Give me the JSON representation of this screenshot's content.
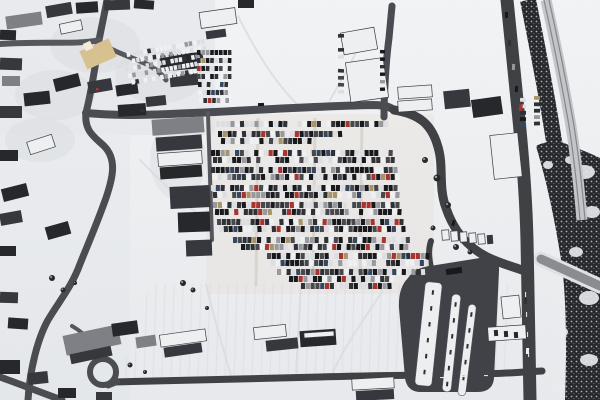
{
  "scene": {
    "type": "aerial photograph",
    "description": "Winter aerial view of a snow-covered town: a large car park full of vehicles in the centre, village buildings to the left, a transit loop with platforms at lower right, a main road and railway line along the right edge, and snow-covered fields."
  },
  "palette": {
    "snow_top": "#f3f4f6",
    "snow_bottom": "#e8eaed",
    "road_dark": "#3f4145",
    "road_mid": "#4a4c51",
    "road_light": "#55575c",
    "asphalt": "#404247",
    "d1": "#26282c",
    "d2": "#36383d",
    "g": "#7e8085",
    "w": "#edeff1",
    "b_stroke": "#3a3c40",
    "church": "#d8c190",
    "church_tower": "#f3ecd9",
    "veg_dark": "#26282b",
    "veg_dot1": "#cfd1d4",
    "veg_dot2": "#9fa1a5",
    "rail_bed": "#c3c5c9",
    "rail_line": "#85878b",
    "bridge": "#8a8c90",
    "bridge_edge": "#dfe1e4",
    "trail": "#d9dbde",
    "track": "#d2ccc4",
    "snow_blob": "#e9ebee",
    "island": "#eceef0",
    "island_stroke": "#54565a",
    "island_dash": "#2e3033",
    "dash_white": "#f2f3f5",
    "car_dark1": "#17191c",
    "car_dark2": "#2e3135",
    "car_dark3": "#46484c",
    "car_light1": "#dcdee1",
    "car_light2": "#eef0f2",
    "car_gray": "#97999d",
    "car_red": "#a8332f",
    "car_blue": "#35465f",
    "car_tan": "#a8946a"
  },
  "ground": {
    "town_tint": {
      "path": "M0,0 L215,0 L215,135 L0,135 Z",
      "color": "#e0e2e6",
      "op": 0.5
    },
    "left_tint": {
      "path": "M0,135 L130,135 L130,400 L0,400 Z",
      "color": "#e0e2e6",
      "op": 0.28
    },
    "lot_tint": {
      "x": 206,
      "y": 114,
      "w": 228,
      "h": 180,
      "color": "#e7e1d8",
      "op": 0.42
    },
    "patches": [
      [
        95,
        45,
        45,
        28
      ],
      [
        55,
        95,
        40,
        25
      ],
      [
        160,
        75,
        45,
        28
      ],
      [
        40,
        140,
        35,
        22
      ],
      [
        178,
        160,
        28,
        40
      ]
    ],
    "patch_color": "#d4d6da",
    "patch_op": 0.35,
    "streak_region": {
      "path": "M150,284 L508,284 L508,372 L120,378 Z",
      "op": 0.5
    }
  },
  "trails": [
    "M238,16 C255,50 276,84 298,105",
    "M330,100 C345,74 356,54 364,36",
    "M206,284 C214,320 224,350 231,376",
    "M301,287 C299,320 297,350 296,375",
    "M382,292 C362,322 342,350 332,375",
    "M140,160 C165,185 185,205 206,220"
  ],
  "lot_tracks": [
    "M258,118 L256,286",
    "M315,118 L313,288",
    "M362,120 L360,288"
  ],
  "vegetation": {
    "main": "M536,146 C548,186 556,226 562,266 C566,298 567,340 565,400 L600,400 L600,158 C588,152 576,148 564,143 C554,140 544,142 536,146 Z",
    "tree_band": "M528,0 C537,45 546,90 553,135 C559,170 564,200 568,228",
    "tree_band_width": 16,
    "snow_blobs": [
      [
        584,
        172,
        11,
        7
      ],
      [
        592,
        212,
        8,
        6
      ],
      [
        576,
        252,
        7,
        5
      ],
      [
        589,
        298,
        10,
        7
      ],
      [
        562,
        332,
        6,
        5
      ],
      [
        589,
        360,
        9,
        6
      ],
      [
        558,
        388,
        7,
        4
      ],
      [
        571,
        160,
        6,
        4
      ],
      [
        548,
        165,
        5,
        4
      ]
    ]
  },
  "railway": {
    "bed": "M546,0 C555,40 563,80 570,120 C575,150 579,185 582,220",
    "line1": "M544,0 C553,40 561,80 568,120 C573,150 577,185 580,220",
    "line2": "M549,0 C558,40 566,80 573,120 C578,150 582,185 585,220",
    "bed_w": 11
  },
  "bridge": {
    "path": "M541,259 L600,286",
    "deck_w": 9,
    "edge_w": 15
  },
  "roads": [
    {
      "n": "road-main-horizontal",
      "p": "M86,113 C130,117 170,114 215,112 C270,109 330,106 372,105 C382,105 389,106 394,110",
      "w": 8,
      "c": "road_mid"
    },
    {
      "n": "road-town-north",
      "p": "M107,0 C104,16 101,30 99,40 C96,62 92,88 86,113",
      "w": 7,
      "c": "road_mid"
    },
    {
      "n": "road-town-west",
      "p": "M99,40 C80,45 40,41 0,44",
      "w": 6,
      "c": "road_light"
    },
    {
      "n": "road-town-spur",
      "p": "M99,42 C114,52 128,56 142,62 C152,66 160,72 166,80",
      "w": 5,
      "c": "road_light"
    },
    {
      "n": "road-diagonal",
      "p": "M86,113 C84,132 96,138 104,146 C118,160 112,180 106,198 C96,226 88,244 80,264 C72,286 60,300 48,320 C38,338 30,368 28,400",
      "w": 7,
      "c": "road_mid"
    },
    {
      "n": "road-lane-east",
      "p": "M208,113 L212,240",
      "w": 4,
      "c": "road_light"
    },
    {
      "n": "road-north-vertical",
      "p": "M384,117 C384,95 386,60 389,38 C390,28 391,16 392,6",
      "w": 7,
      "c": "road_mid"
    },
    {
      "n": "road-s-curve",
      "p": "M394,110 C420,114 432,125 438,147 C444,167 438,186 446,208 C454,232 468,247 487,257 C502,264 514,267 522,270",
      "w": 9,
      "c": "road_dark"
    },
    {
      "n": "road-loop-connector",
      "p": "M431,268 C429,258 428,250 431,241",
      "w": 6,
      "c": "road_dark"
    },
    {
      "n": "road-main-vertical",
      "p": "M507,0 C511,40 515,80 519,120 C523,160 526,200 527,240 C528,280 529,330 530,400",
      "w": 13,
      "c": "road_dark"
    },
    {
      "n": "road-bottom",
      "p": "M114,382 C180,381 250,379 320,377 C390,375 450,375 480,374 C500,374 520,372 542,371",
      "w": 7,
      "c": "road_dark"
    },
    {
      "n": "road-bottom-left",
      "p": "M0,377 C20,384 42,393 62,400",
      "w": 7,
      "c": "road_mid"
    },
    {
      "n": "road-circle-spur",
      "p": "M101,358 C96,346 86,334 72,326",
      "w": 4,
      "c": "road_light"
    },
    {
      "n": "road-circle-link",
      "p": "M108,386 L118,382",
      "w": 5,
      "c": "road_mid"
    }
  ],
  "circle_drive": {
    "cx": 103,
    "cy": 372,
    "r": 13,
    "w": 6
  },
  "transit": {
    "apron": "M408,278 Q414,268 430,266 L486,257 Q500,257 499,271 L494,378 Q493,392 477,392 L421,392 Q407,392 405,378 L399,308 Q398,288 408,278 Z",
    "islands": [
      [
        420,
        282,
        17,
        104,
        6
      ],
      [
        447,
        294,
        9,
        98,
        6
      ],
      [
        463,
        304,
        8,
        92,
        7
      ]
    ],
    "bus": [
      446,
      268,
      16,
      6,
      -8
    ]
  },
  "church": {
    "main": [
      82,
      44,
      32,
      20,
      -24
    ],
    "tower": [
      84,
      42,
      8,
      8,
      -24
    ]
  },
  "buildings": [
    [
      6,
      14,
      36,
      13,
      -8,
      "g"
    ],
    [
      46,
      4,
      26,
      12,
      -10,
      "d2"
    ],
    [
      76,
      2,
      22,
      11,
      -4,
      "d1"
    ],
    [
      104,
      0,
      26,
      10,
      -2,
      "d2"
    ],
    [
      134,
      0,
      20,
      9,
      4,
      "d1"
    ],
    [
      60,
      22,
      22,
      10,
      -12,
      "w"
    ],
    [
      0,
      30,
      16,
      10,
      2,
      "d1"
    ],
    [
      0,
      58,
      22,
      12,
      2,
      "d2"
    ],
    [
      2,
      76,
      18,
      10,
      0,
      "g"
    ],
    [
      54,
      76,
      26,
      13,
      -14,
      "d1"
    ],
    [
      88,
      80,
      24,
      12,
      -10,
      "d2"
    ],
    [
      116,
      84,
      22,
      11,
      -8,
      "d1"
    ],
    [
      160,
      54,
      38,
      16,
      -5,
      "d1"
    ],
    [
      170,
      74,
      28,
      12,
      -5,
      "d2"
    ],
    [
      24,
      92,
      26,
      13,
      -6,
      "d1"
    ],
    [
      0,
      106,
      22,
      12,
      0,
      "d2"
    ],
    [
      118,
      104,
      28,
      12,
      -4,
      "d1"
    ],
    [
      146,
      96,
      20,
      10,
      -6,
      "d2"
    ],
    [
      200,
      10,
      36,
      16,
      -8,
      "w"
    ],
    [
      206,
      30,
      20,
      8,
      -8,
      "d2"
    ],
    [
      238,
      0,
      16,
      8,
      0,
      "d1"
    ],
    [
      28,
      138,
      26,
      13,
      -18,
      "w"
    ],
    [
      0,
      150,
      18,
      11,
      0,
      "d1"
    ],
    [
      2,
      186,
      26,
      13,
      -14,
      "d1"
    ],
    [
      0,
      212,
      22,
      12,
      -10,
      "d2"
    ],
    [
      46,
      224,
      24,
      13,
      -16,
      "d1"
    ],
    [
      0,
      246,
      16,
      10,
      0,
      "d1"
    ],
    [
      0,
      292,
      18,
      11,
      2,
      "d2"
    ],
    [
      8,
      318,
      20,
      11,
      4,
      "d1"
    ],
    [
      152,
      118,
      52,
      16,
      -4,
      "g"
    ],
    [
      156,
      136,
      46,
      14,
      -4,
      "d2"
    ],
    [
      158,
      152,
      44,
      13,
      -4,
      "w"
    ],
    [
      160,
      166,
      42,
      12,
      -4,
      "d1"
    ],
    [
      170,
      186,
      40,
      22,
      -3,
      "d2"
    ],
    [
      178,
      212,
      32,
      20,
      -2,
      "d1"
    ],
    [
      186,
      240,
      26,
      16,
      -2,
      "d2"
    ],
    [
      342,
      30,
      34,
      22,
      -10,
      "w"
    ],
    [
      348,
      60,
      38,
      40,
      -8,
      "w"
    ],
    [
      398,
      86,
      34,
      12,
      -4,
      "w"
    ],
    [
      398,
      100,
      34,
      11,
      -4,
      "w"
    ],
    [
      444,
      90,
      26,
      18,
      -6,
      "d2"
    ],
    [
      472,
      98,
      30,
      18,
      -8,
      "d1"
    ],
    [
      492,
      134,
      28,
      44,
      -6,
      "w"
    ],
    [
      64,
      330,
      56,
      20,
      -12,
      "g"
    ],
    [
      70,
      350,
      42,
      10,
      -12,
      "d2"
    ],
    [
      160,
      332,
      46,
      12,
      -8,
      "w"
    ],
    [
      164,
      345,
      38,
      10,
      -8,
      "d2"
    ],
    [
      254,
      326,
      32,
      12,
      -6,
      "w"
    ],
    [
      266,
      339,
      32,
      11,
      -6,
      "d2"
    ],
    [
      300,
      330,
      36,
      16,
      -4,
      "d1"
    ],
    [
      304,
      332,
      30,
      5,
      -4,
      "w"
    ],
    [
      352,
      378,
      42,
      11,
      -3,
      "w"
    ],
    [
      356,
      390,
      38,
      10,
      -3,
      "d2"
    ],
    [
      112,
      322,
      26,
      13,
      -8,
      "d1"
    ],
    [
      136,
      336,
      20,
      11,
      -8,
      "g"
    ],
    [
      0,
      360,
      20,
      14,
      0,
      "d1"
    ],
    [
      28,
      372,
      20,
      12,
      -6,
      "d2"
    ],
    [
      58,
      388,
      18,
      10,
      0,
      "d1"
    ],
    [
      96,
      392,
      16,
      8,
      0,
      "d2"
    ],
    [
      502,
      296,
      18,
      22,
      -6,
      "w"
    ],
    [
      488,
      326,
      38,
      14,
      -4,
      "w"
    ],
    [
      494,
      330,
      4,
      6,
      -4,
      "d1"
    ],
    [
      504,
      331,
      4,
      6,
      -4,
      "d1"
    ],
    [
      514,
      332,
      4,
      6,
      -4,
      "d1"
    ],
    [
      442,
      230,
      7,
      10,
      -4,
      "w"
    ],
    [
      451,
      231,
      7,
      10,
      -4,
      "w"
    ],
    [
      460,
      232,
      7,
      10,
      -4,
      "w"
    ],
    [
      469,
      233,
      7,
      10,
      -4,
      "w"
    ],
    [
      478,
      234,
      7,
      10,
      -4,
      "w"
    ],
    [
      487,
      235,
      6,
      9,
      -4,
      "d2"
    ]
  ],
  "lots": [
    {
      "name": "main-parking-lot",
      "car_w": 4.1,
      "car_h": 6,
      "pitch": 4.8,
      "weights": "mixed",
      "rows": [
        [
          121,
          216,
          392
        ],
        [
          131,
          218,
          346
        ],
        [
          138,
          221,
          312
        ],
        [
          150,
          211,
          396
        ],
        [
          157,
          213,
          398
        ],
        [
          167,
          211,
          399
        ],
        [
          174,
          213,
          400
        ],
        [
          185,
          211,
          402
        ],
        [
          192,
          213,
          403
        ],
        [
          202,
          213,
          404
        ],
        [
          209,
          215,
          405
        ],
        [
          219,
          217,
          407
        ],
        [
          226,
          219,
          408
        ],
        [
          237,
          233,
          410
        ],
        [
          244,
          241,
          412
        ],
        [
          253,
          267,
          430
        ],
        [
          260,
          271,
          432
        ],
        [
          269,
          277,
          426
        ],
        [
          276,
          289,
          398
        ],
        [
          283,
          301,
          392
        ]
      ]
    },
    {
      "name": "church-lot",
      "car_w": 3.4,
      "car_h": 4.6,
      "pitch": 4.2,
      "weights": "light",
      "rot": -10,
      "cx": 165,
      "cy": 60,
      "rows": [
        [
          46,
          124,
          208
        ],
        [
          53,
          124,
          208
        ],
        [
          60,
          124,
          206
        ],
        [
          67,
          126,
          206
        ],
        [
          74,
          128,
          204
        ]
      ]
    },
    {
      "name": "north-lot",
      "car_w": 3.6,
      "car_h": 5,
      "pitch": 4.4,
      "weights": "mixed",
      "rows": [
        [
          50,
          197,
          234
        ],
        [
          58,
          197,
          234
        ],
        [
          66,
          197,
          232
        ],
        [
          74,
          197,
          232
        ],
        [
          82,
          198,
          232
        ],
        [
          90,
          198,
          230
        ],
        [
          98,
          199,
          230
        ]
      ]
    },
    {
      "name": "roadside-lot",
      "car_w": 6,
      "car_h": 3.8,
      "pitch": 6.4,
      "weights": "mixed",
      "vrows": [
        [
          520,
          98,
          128
        ],
        [
          534,
          96,
          126
        ]
      ]
    },
    {
      "name": "west-column",
      "car_w": 6,
      "car_h": 3.6,
      "pitch": 7,
      "weights": "mixed",
      "vrows": [
        [
          338,
          34,
          104
        ]
      ]
    },
    {
      "name": "east-column",
      "car_w": 5,
      "car_h": 3.4,
      "pitch": 7.5,
      "weights": "dark",
      "vrows": [
        [
          380,
          50,
          96
        ]
      ]
    }
  ],
  "car_weights": {
    "mixed": [
      [
        "car_dark1",
        0.22
      ],
      [
        "car_dark2",
        0.18
      ],
      [
        "car_dark3",
        0.12
      ],
      [
        "car_light1",
        0.16
      ],
      [
        "car_light2",
        0.12
      ],
      [
        "car_gray",
        0.1
      ],
      [
        "car_red",
        0.04
      ],
      [
        "car_blue",
        0.04
      ],
      [
        "car_tan",
        0.02
      ]
    ],
    "light": [
      [
        "car_light2",
        0.45
      ],
      [
        "car_light1",
        0.3
      ],
      [
        "car_gray",
        0.15
      ],
      [
        "car_dark2",
        0.1
      ]
    ],
    "dark": [
      [
        "car_dark1",
        0.4
      ],
      [
        "car_dark2",
        0.3
      ],
      [
        "car_dark3",
        0.15
      ],
      [
        "car_gray",
        0.15
      ]
    ]
  },
  "vehicles": [
    [
      505,
      12,
      3,
      6,
      "car_dark1",
      0
    ],
    [
      508,
      40,
      3,
      6,
      "car_dark2",
      2
    ],
    [
      512,
      64,
      3,
      6,
      "car_gray",
      3
    ],
    [
      515,
      86,
      3,
      6,
      "car_dark1",
      3
    ],
    [
      519,
      104,
      3.5,
      7,
      "car_red",
      4
    ],
    [
      524,
      298,
      3,
      6,
      "car_dark2",
      2
    ],
    [
      526,
      348,
      3,
      6,
      "car_light2",
      2
    ],
    [
      258,
      103,
      6,
      3,
      "car_dark1",
      -3
    ],
    [
      140,
      109,
      5,
      3,
      "car_dark2",
      -2
    ],
    [
      96,
      88,
      2.5,
      2.5,
      "car_red",
      0
    ],
    [
      452,
      220,
      3,
      6,
      "car_dark1",
      15
    ]
  ],
  "lane_dashes_v": [
    [
      525,
      292
    ],
    [
      526,
      312
    ],
    [
      527,
      332
    ],
    [
      528,
      352
    ]
  ],
  "lane_dashes_h": [
    [
      440,
      377
    ],
    [
      462,
      376
    ],
    [
      484,
      375
    ]
  ],
  "trees": [
    [
      52,
      278,
      3
    ],
    [
      63,
      290,
      2.5
    ],
    [
      75,
      283,
      2
    ],
    [
      183,
      283,
      3
    ],
    [
      193,
      290,
      2.5
    ],
    [
      207,
      308,
      2
    ],
    [
      130,
      365,
      2.5
    ],
    [
      145,
      372,
      2
    ],
    [
      437,
      178,
      3.5
    ],
    [
      448,
      205,
      3
    ],
    [
      433,
      228,
      2.5
    ],
    [
      456,
      247,
      3
    ],
    [
      470,
      252,
      2.5
    ],
    [
      425,
      160,
      3
    ]
  ],
  "seed": 11,
  "gap_probability": 0.08
}
